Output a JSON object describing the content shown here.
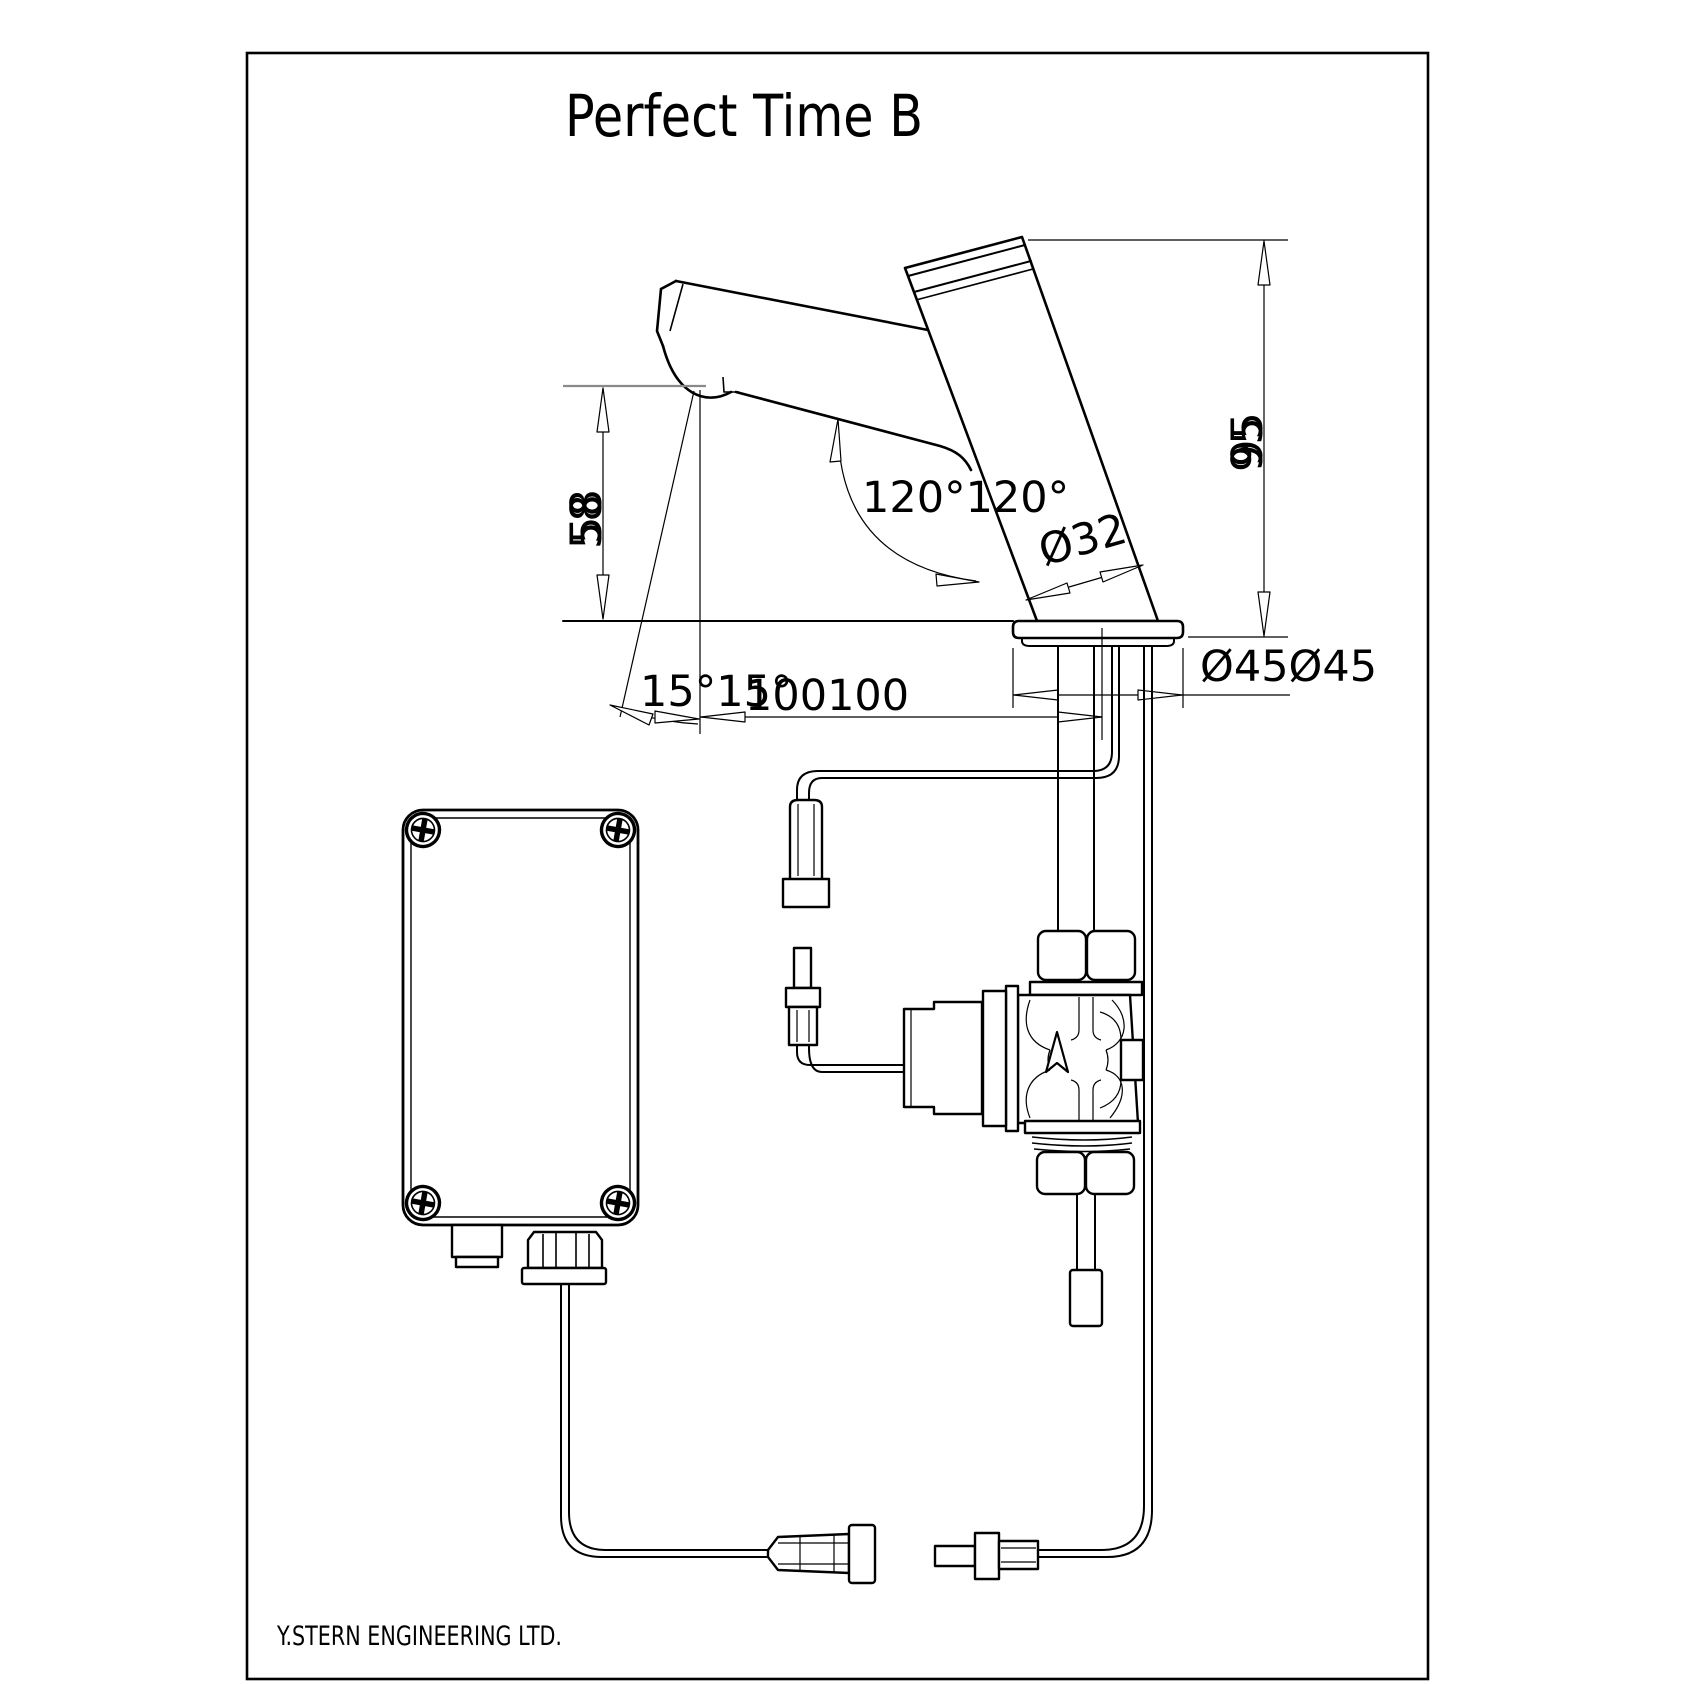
{
  "page": {
    "title": "Perfect Time B",
    "footer": "Y.STERN ENGINEERING LTD."
  },
  "drawing": {
    "type": "technical-dimension-drawing",
    "subject": "sensor faucet with solenoid valve and control box",
    "colors": {
      "line": "#000000",
      "background": "#ffffff",
      "reference_line": "#8a8a8a"
    }
  },
  "labels": {
    "spout_height": "58",
    "total_height": "95",
    "spout_body_angle": "120°120°",
    "body_diameter": "Ø32",
    "tilt_angle": "15°15°",
    "reach": "100100",
    "base_diameter": "Ø45Ø45"
  }
}
